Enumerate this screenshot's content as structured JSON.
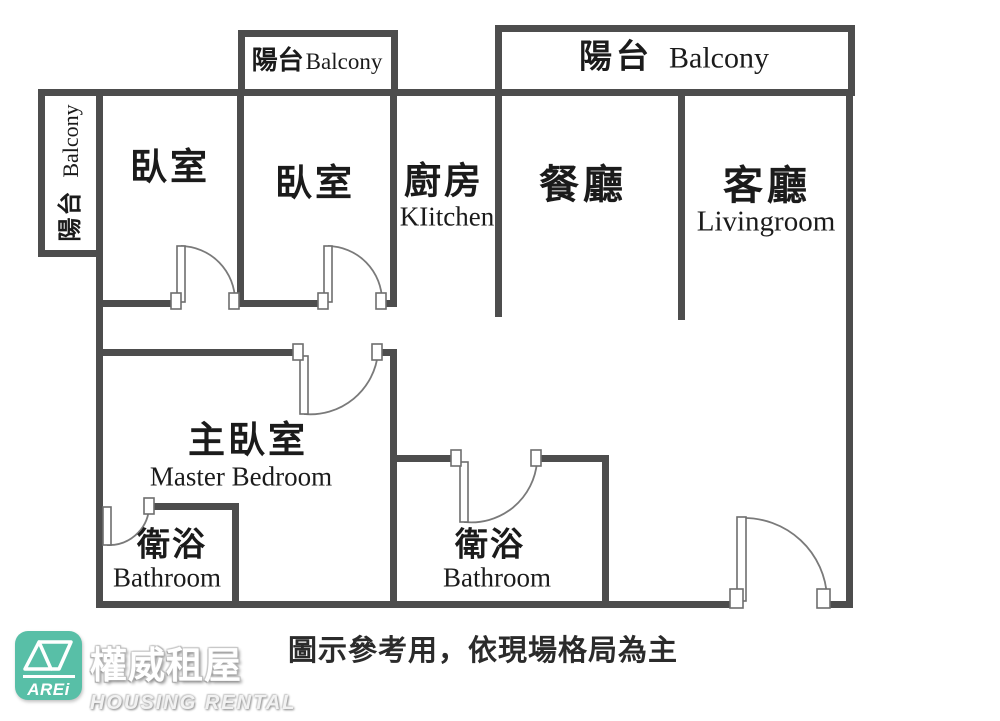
{
  "floorplan": {
    "balconies": {
      "left": {
        "zh": "陽台",
        "en": "Balcony"
      },
      "top_small": {
        "zh": "陽台",
        "en": "Balcony"
      },
      "top_large": {
        "zh": "陽台",
        "en": "Balcony"
      }
    },
    "rooms": {
      "bedroom1": {
        "zh": "臥室"
      },
      "bedroom2": {
        "zh": "臥室"
      },
      "kitchen": {
        "zh": "廚房",
        "en": "KIitchen"
      },
      "dining": {
        "zh": "餐廳"
      },
      "living": {
        "zh": "客廳",
        "en": "Livingroom"
      },
      "master_bedroom": {
        "zh": "主臥室",
        "en": "Master Bedroom"
      },
      "bathroom_master": {
        "zh": "衛浴",
        "en": "Bathroom"
      },
      "bathroom_hall": {
        "zh": "衛浴",
        "en": "Bathroom"
      }
    }
  },
  "footer": {
    "disclaimer": "圖示參考用，依現場格局為主",
    "logo": {
      "badge": "AREi",
      "brand_zh": "權威租屋",
      "brand_en": "HOUSING RENTAL"
    }
  },
  "colors": {
    "wall": "#4d4d4d",
    "logo_teal": "#58bfa7"
  }
}
